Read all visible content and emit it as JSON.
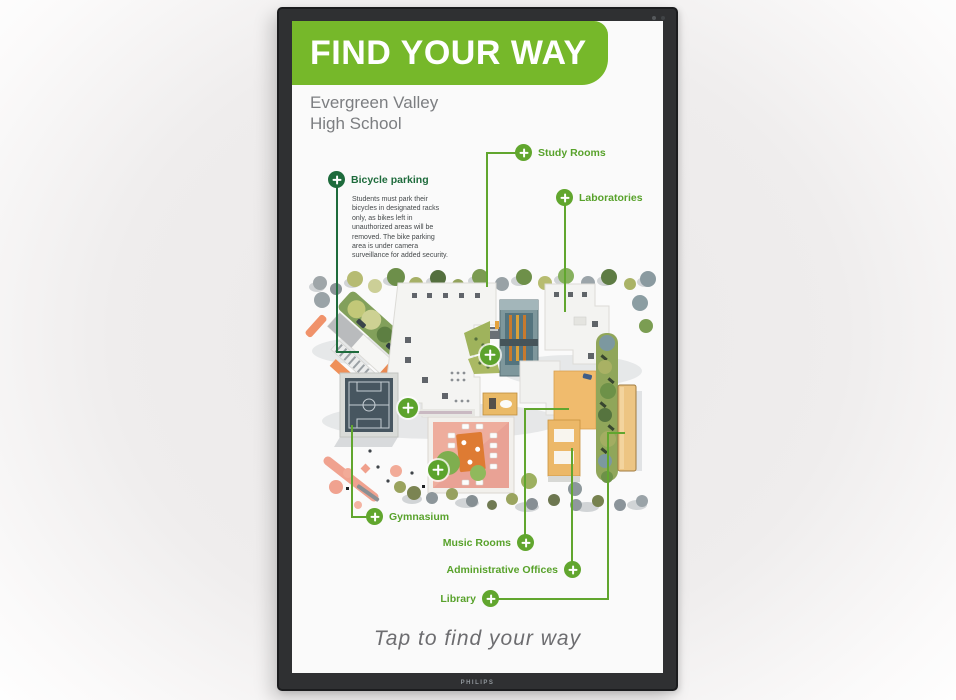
{
  "device": {
    "brand_label": "PHILIPS"
  },
  "header": {
    "title": "FIND YOUR WAY",
    "subtitle_lines": [
      "Evergreen Valley",
      "High School"
    ]
  },
  "selected_location": {
    "label": "Bicycle parking",
    "description": "Students must park their bicycles in designated racks only, as bikes left in unauthorized areas will be removed. The bike parking area is under camera surveillance for added security."
  },
  "locations": {
    "study_rooms": "Study Rooms",
    "laboratories": "Laboratories",
    "gymnasium": "Gymnasium",
    "music_rooms": "Music Rooms",
    "admin_offices": "Administrative Offices",
    "library": "Library"
  },
  "footer": {
    "cta": "Tap to find your way"
  },
  "colors": {
    "brand_green": "#76b82a",
    "marker_green": "#5ca32c",
    "selected_dark_green": "#1e6b3c"
  }
}
